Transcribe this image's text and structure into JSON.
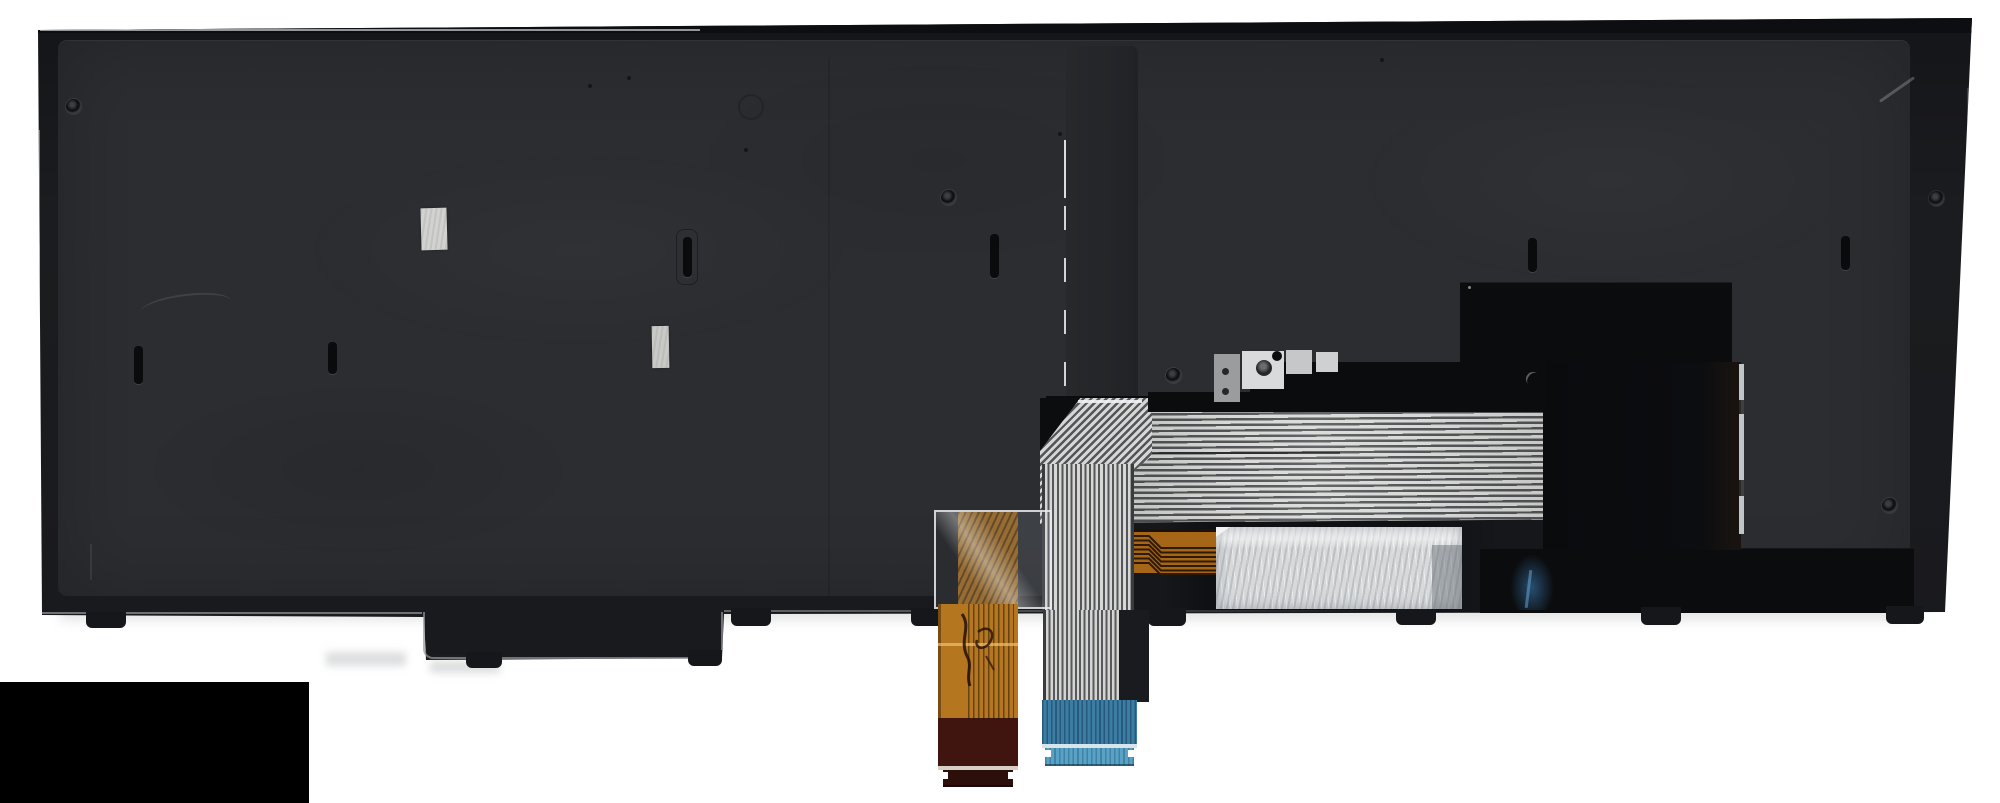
{
  "meta": {
    "type": "product-photo",
    "subject": "Rear side of a black laptop keyboard assembly (replacement part) with backlight module and two flex ribbon cables hanging below; solid black censor rectangle in lower-left corner",
    "visible_text": "none (only an illegible handwritten mark on the orange cable)"
  },
  "palette": {
    "background": "#ffffff",
    "panel_surface": "#2b2d31",
    "panel_frame": "#17181a",
    "panel_rim": "#0d0e11",
    "rib": "#26282b",
    "module_black": "#0b0c0e",
    "gloss_black": "#0e1013",
    "stripe_light": "#d9d9d7",
    "stripe_dark": "#545558",
    "blue_stiffener": "#3b7da3",
    "blue_tip": "#57a2c5",
    "blue_divider": "#d8e4ec",
    "orange_copper": "#b4761f",
    "orange_under_film": "#8f5e1c",
    "maroon": "#40150f",
    "maroon_tip": "#2c0f0a",
    "orange_divider": "#d8cfc5",
    "zigzag_copper": "#a56617",
    "silver_sticker": "#d7d9db",
    "small_sticker_1": "#d2d2d0",
    "small_sticker_2": "#c9c9c7",
    "bracket_metal": "#9a9c9e",
    "bracket_plate": "#9a9c9e",
    "bracket_pad_bright": "#d9dadb",
    "bracket_pad_mid": "#c6c7c9",
    "bracket_pad_small": "#ced0d1",
    "tab": "#16171a",
    "censor_block": "#000000"
  },
  "objects": [
    "keyboard-back-panel",
    "mounting-screw-holes",
    "hook-slots",
    "foil-stickers",
    "center-stiffener-rib",
    "backlight-film-stack",
    "metal-bracket",
    "white-striped-ffc-cable-with-blue-stiffener",
    "orange-fpc-cable-with-handwritten-mark",
    "silver-hologram-sticker",
    "mounting-tabs",
    "censor-rectangle"
  ]
}
